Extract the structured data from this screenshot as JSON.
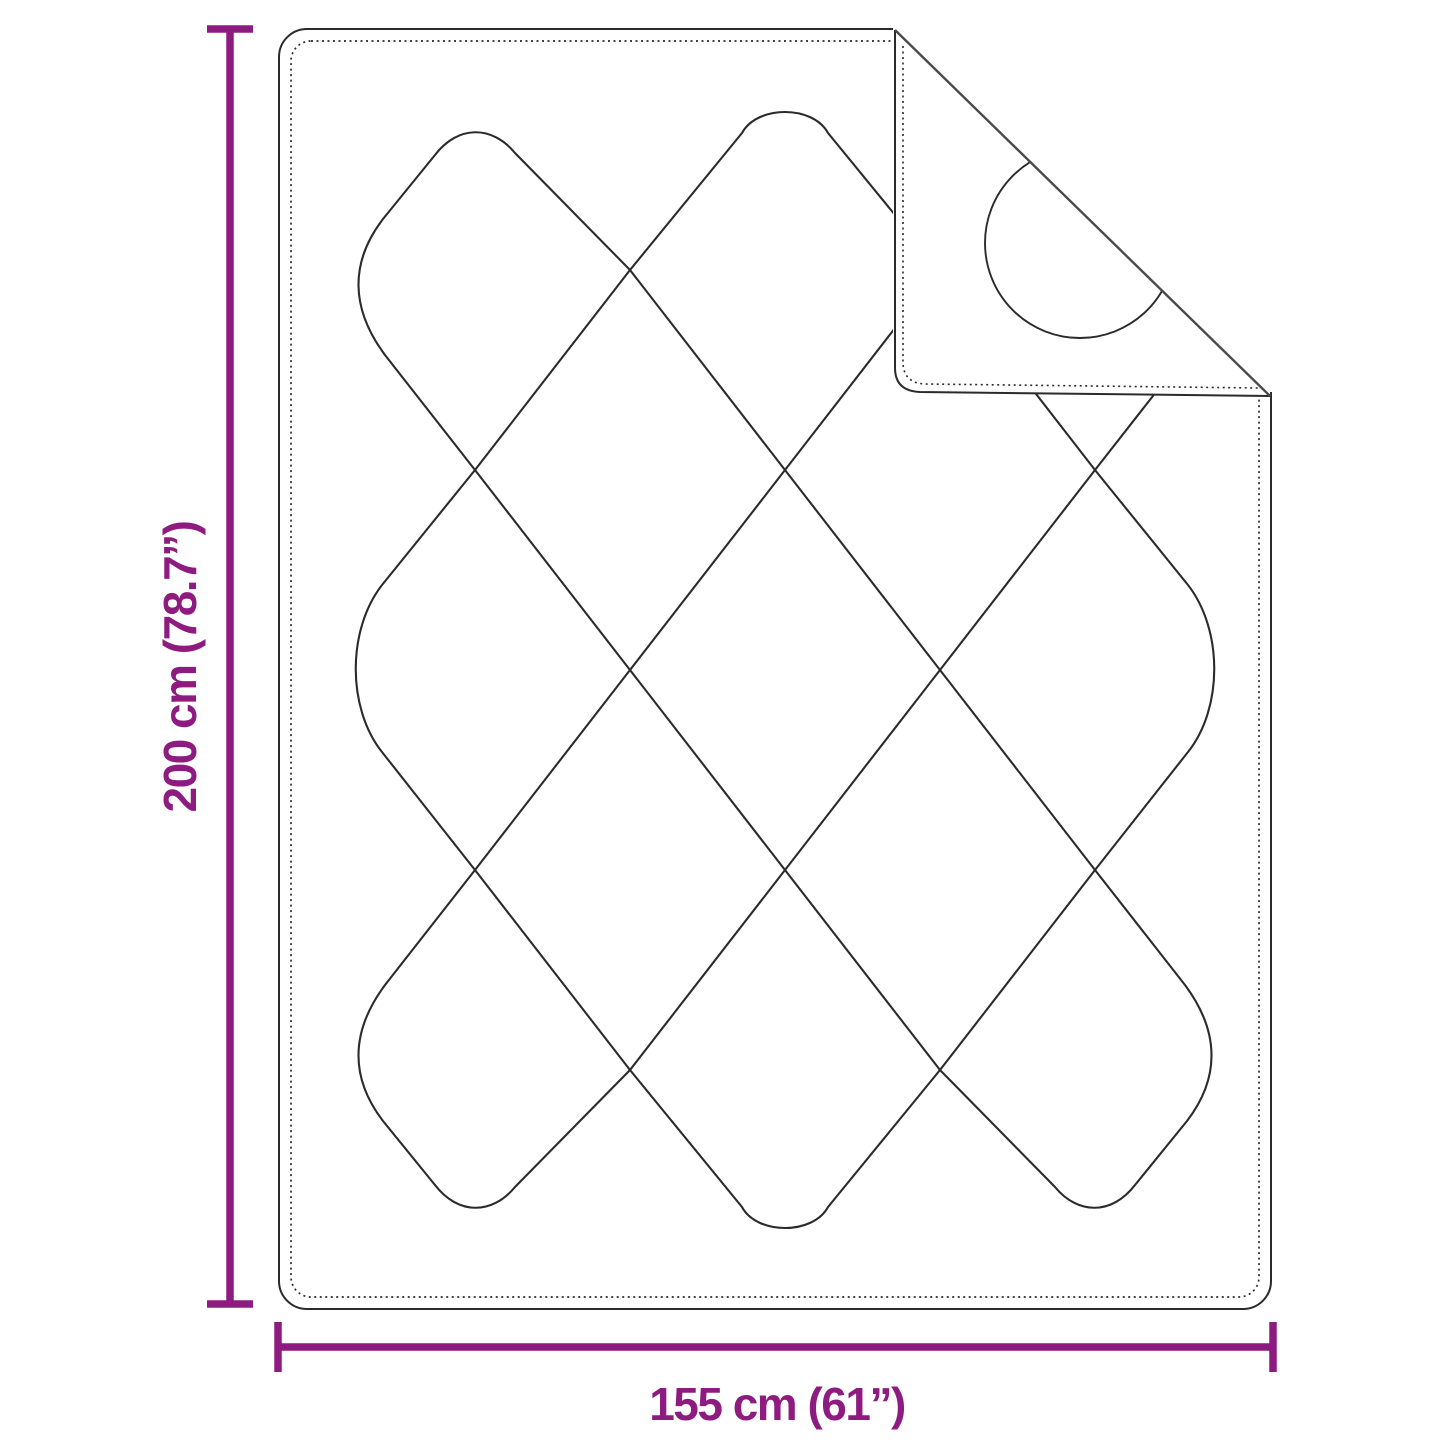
{
  "diagram": {
    "subject": "quilted-blanket-with-folded-corner",
    "vertical_dimension": {
      "label": "200 cm (78.7”)"
    },
    "horizontal_dimension": {
      "label": "155 cm (61”)"
    },
    "colors": {
      "dimension_accent": "#8E1C80",
      "drawing_line": "#2b2b2b",
      "background": "#ffffff"
    }
  }
}
